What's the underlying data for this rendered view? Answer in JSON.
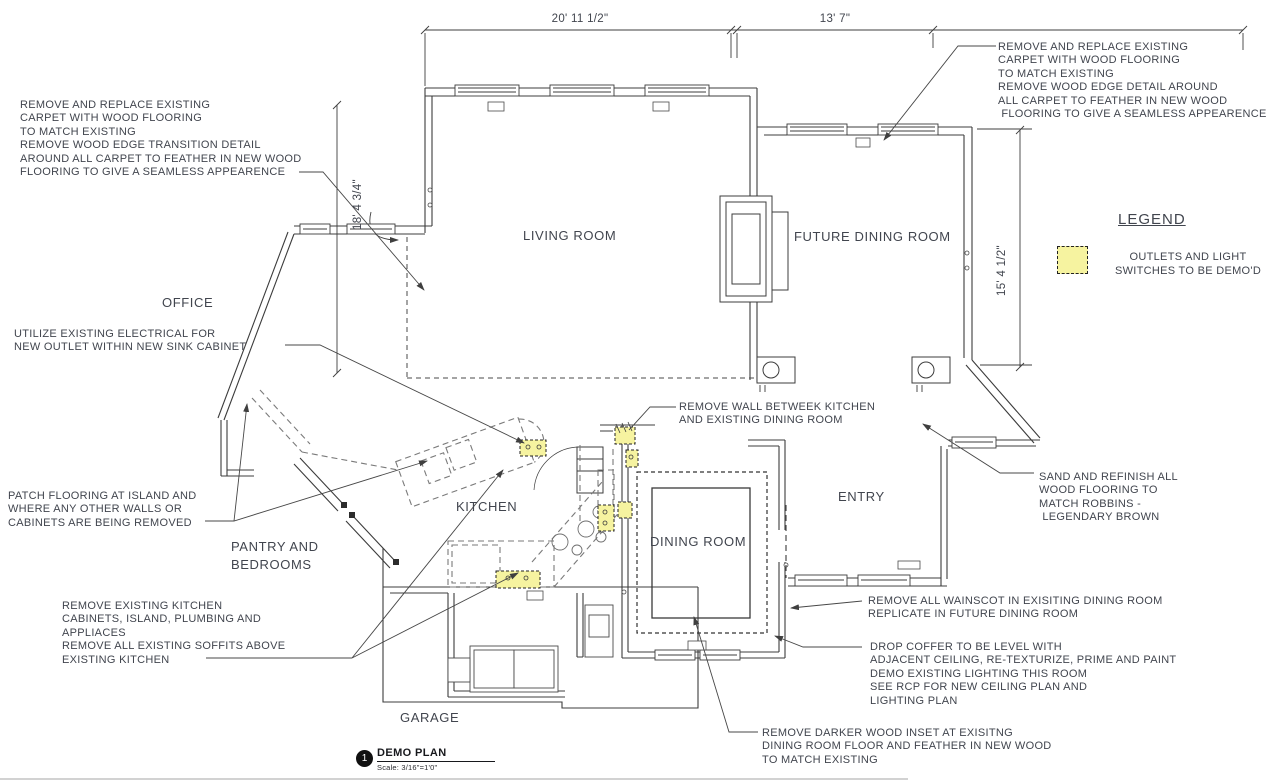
{
  "colors": {
    "highlight": "#f6f3a0",
    "ink": "#41454e",
    "line": "#3c3c3c"
  },
  "dimensions": {
    "top_left": "20' 11 1/2\"",
    "top_right": "13' 7\"",
    "left_side": "18' 4 3/4\"",
    "right_side": "15' 4 1/2\""
  },
  "rooms": {
    "living_room": "LIVING ROOM",
    "future_dining_room": "FUTURE DINING ROOM",
    "office": "OFFICE",
    "kitchen": "KITCHEN",
    "pantry": "PANTRY AND\nBEDROOMS",
    "dining_room": "DINING ROOM",
    "entry": "ENTRY",
    "garage": "GARAGE"
  },
  "annotations": {
    "carpet_left": "REMOVE AND REPLACE EXISTING\nCARPET WITH WOOD FLOORING\nTO MATCH EXISTING\nREMOVE WOOD EDGE TRANSITION DETAIL\nAROUND ALL CARPET TO FEATHER IN NEW WOOD\nFLOORING TO GIVE A SEAMLESS APPEARENCE",
    "carpet_right": "REMOVE AND REPLACE EXISTING\nCARPET WITH WOOD FLOORING\nTO MATCH EXISTING\nREMOVE WOOD EDGE DETAIL AROUND\nALL CARPET TO FEATHER IN NEW WOOD\n FLOORING TO GIVE A SEAMLESS APPEARENCE",
    "electrical": "UTILIZE EXISTING ELECTRICAL FOR\nNEW OUTLET WITHIN NEW SINK CABINET",
    "remove_wall": "REMOVE WALL BETWEEK KITCHEN\nAND EXISTING DINING ROOM",
    "patch_flooring": "PATCH FLOORING AT ISLAND AND\nWHERE ANY OTHER WALLS OR\nCABINETS ARE BEING REMOVED",
    "remove_kitchen": "REMOVE EXISTING KITCHEN\nCABINETS, ISLAND, PLUMBING AND\nAPPLIACES\nREMOVE ALL EXISTING SOFFITS ABOVE\nEXISTING KITCHEN",
    "sand_refinish": "SAND AND REFINISH ALL\nWOOD FLOORING TO\nMATCH ROBBINS -\n LEGENDARY BROWN",
    "wainscot": "REMOVE ALL WAINSCOT IN EXISITING DINING ROOM\nREPLICATE IN FUTURE DINING ROOM",
    "drop_coffer": "DROP COFFER TO BE LEVEL WITH\nADJACENT CEILING, RE-TEXTURIZE, PRIME AND PAINT\nDEMO EXISTING LIGHTING THIS ROOM\nSEE RCP FOR NEW CEILING PLAN AND\nLIGHTING PLAN",
    "wood_inset": "REMOVE DARKER WOOD INSET AT EXISITNG\nDINING ROOM FLOOR AND FEATHER IN NEW WOOD\nTO MATCH EXISTING"
  },
  "legend": {
    "title": "LEGEND",
    "item": "OUTLETS AND LIGHT\nSWITCHES TO BE DEMO'D"
  },
  "title_block": {
    "number": "1",
    "title": "DEMO PLAN",
    "scale": "Scale: 3/16\"=1'0\""
  }
}
